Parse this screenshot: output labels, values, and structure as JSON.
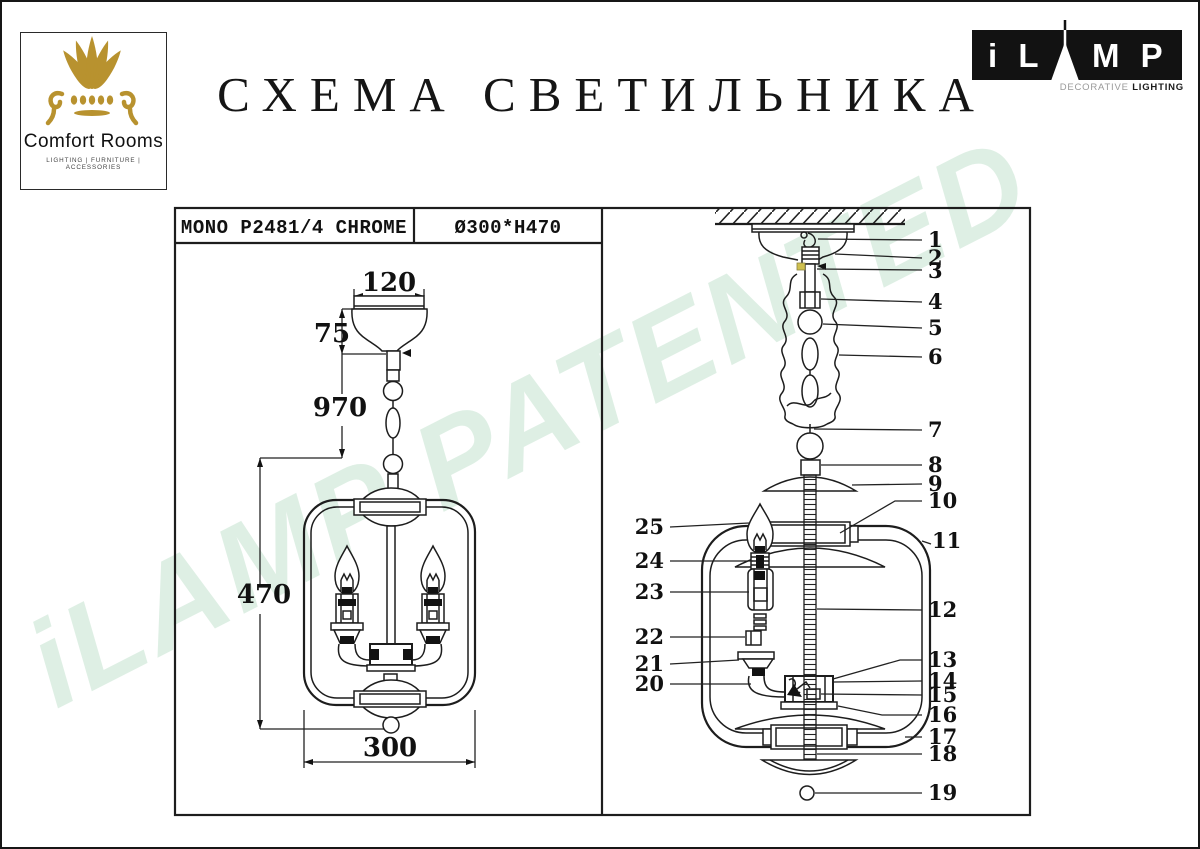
{
  "branding": {
    "comfort_rooms": {
      "name": "Comfort Rooms",
      "tagline": "LIGHTING  |  FURNITURE  |  ACCESSORIES",
      "logo_color": "#b8922f"
    },
    "ilamp": {
      "letters_left": "i L",
      "letters_right": "M P",
      "tagline_light": "DECORATIVE ",
      "tagline_bold": "LIGHTING"
    }
  },
  "title": "СХЕМА СВЕТИЛЬНИКА",
  "spec": {
    "model": "MONO P2481/4 CHROME",
    "size": "Ø300*H470"
  },
  "watermark": {
    "text": "iLAMP PATENTED",
    "color": "#dcefe2"
  },
  "diagram": {
    "dimensions": {
      "d120": "120",
      "d75": "75",
      "d970": "970",
      "d470": "470",
      "d300": "300"
    },
    "callouts": {
      "c1": "1",
      "c2": "2",
      "c3": "3",
      "c4": "4",
      "c5": "5",
      "c6": "6",
      "c7": "7",
      "c8": "8",
      "c9": "9",
      "c10": "10",
      "c11": "11",
      "c12": "12",
      "c13": "13",
      "c14": "14",
      "c15": "15",
      "c16": "16",
      "c17": "17",
      "c18": "18",
      "c19": "19",
      "c20": "20",
      "c21": "21",
      "c22": "22",
      "c23": "23",
      "c24": "24",
      "c25": "25"
    },
    "accent_yellow": "#cfc04f"
  }
}
